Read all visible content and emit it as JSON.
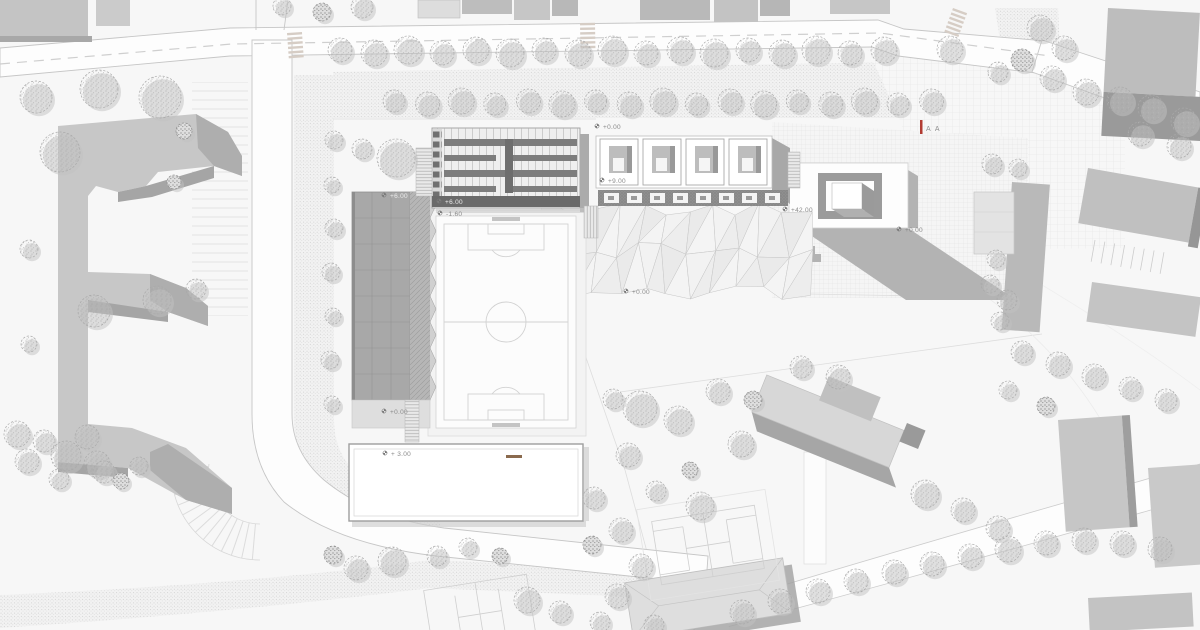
{
  "drawing": {
    "type": "architectural site plan – sports complex masterplan",
    "section_marker": "A A",
    "levels": {
      "plaza_top": "+0.00",
      "pavilions": "+9.00",
      "grandstand_top": "+6.00",
      "sports_hall": "+6.00",
      "soccer_field": "-1.60",
      "tower": "+42.00",
      "tower_plaza": "+0.00",
      "park": "+0.00",
      "grandstand_base": "+0.00",
      "pool": "+ 3.00"
    },
    "colors": {
      "paper": "#f7f7f7",
      "building_light": "#c7c7c7",
      "building_mid": "#b0b0b0",
      "building_dark": "#8f8f8f",
      "shadow": "#a9a9a9",
      "drawing_line": "#c9c9c9",
      "accent_red": "#b23b32",
      "diving_board": "#8a6a4e"
    },
    "icons": {
      "level_marker": "level-marker-icon",
      "section_cut": "section-cut-marker"
    }
  }
}
